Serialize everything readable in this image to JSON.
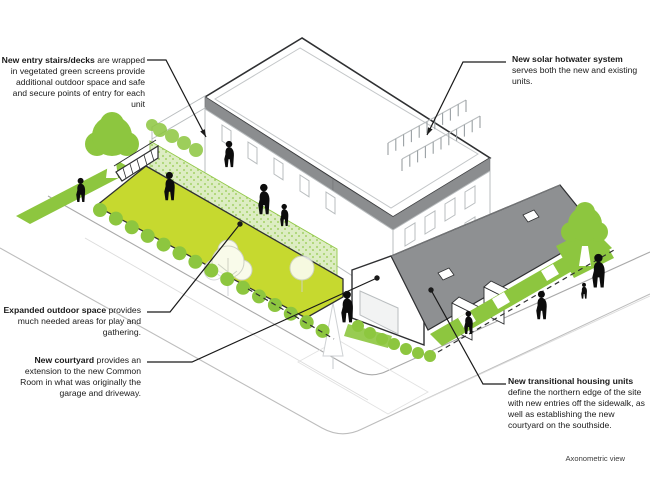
{
  "figure": {
    "caption": "Axonometric view",
    "annotations": [
      {
        "id": "entry-stairs",
        "lead": "New entry stairs/decks",
        "rest": " are wrapped in vegetated green screens provide additional outdoor space and safe and secure points of entry for each unit"
      },
      {
        "id": "solar-hotwater",
        "lead": "New solar hotwater system",
        "rest": " serves both the new and existing units."
      },
      {
        "id": "expanded-outdoor-space",
        "lead": "Expanded outdoor space",
        "rest": " provides much needed areas for play and gathering."
      },
      {
        "id": "new-courtyard",
        "lead": "New courtyard",
        "rest": " provides an extension to the new Common Room in what was originally the garage and driveway."
      },
      {
        "id": "transitional-housing",
        "lead": "New transitional housing units",
        "rest": " define the northern edge of the site with new entries off the sidewalk, as well as establishing the new courtyard on the southside."
      }
    ],
    "colors": {
      "lawn": "#c6d92f",
      "foliage": "#8dc63f",
      "green_screen": "#dcedc0",
      "dark_roof": "#8e9092",
      "fascia": "#8b8d8f",
      "outline": "#2f3032",
      "light_line": "#c3c6c8",
      "street_line": "#bfbfbf",
      "figure_silhouette": "#0c0c0c",
      "annotation_text": "#1a1a1a"
    }
  }
}
